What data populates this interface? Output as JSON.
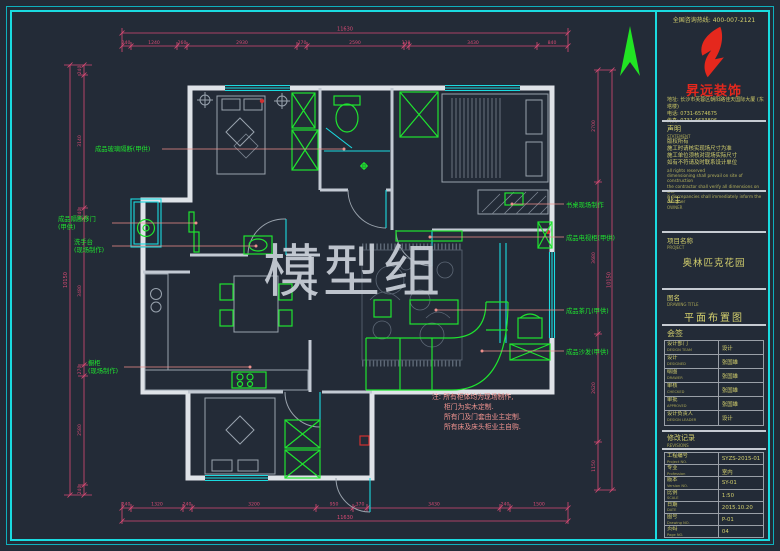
{
  "watermark": "模型组",
  "title_block": {
    "hotline": "全国咨询热线: 400-007-2121",
    "brand_name": "昇远装饰",
    "address": "地址: 长沙市芙蓉区朝阳路佳天国际大厦 (东塔楼)",
    "phone": "电话: 0731-6574675",
    "fax": "传真: 0731-4633806",
    "statement_label": "声明",
    "statement_sub": "STATEMENT",
    "statement_lines": [
      "版权所有",
      "施工时请核实现场尺寸为准",
      "施工单位须核对现场实际尺寸",
      "如有不符请及时联系设计单位"
    ],
    "statement_en": [
      "all rights reserved",
      "dimensioning shall prevail on site of construction",
      "the contractor shall verify all dimensions on site",
      "if discrepancies shall immediately inform the designer"
    ],
    "owner_label": "业主",
    "owner_sub": "OWNER",
    "project_label": "项目名称",
    "project_sub": "PROJECT",
    "project_name": "奥林匹克花园",
    "drawing_label": "图名",
    "drawing_sub": "DRAWING TITLE",
    "drawing_name": "平面布置图",
    "sign_label": "会签",
    "team_rows": [
      {
        "label": "设计部门",
        "sub": "DESIGN TEAM",
        "value": "设计"
      },
      {
        "label": "设计",
        "sub": "DESIGNED",
        "value": "张国雄"
      },
      {
        "label": "绘图",
        "sub": "DRAWER",
        "value": "张国雄"
      },
      {
        "label": "审核",
        "sub": "CHECKED",
        "value": "张国雄"
      },
      {
        "label": "审批",
        "sub": "APPROVED",
        "value": "张国雄"
      },
      {
        "label": "设计负责人",
        "sub": "DESIGN LEADER",
        "value": "设计"
      }
    ],
    "revision_label": "修改记录",
    "revision_sub": "REVISIONS",
    "info_rows": [
      {
        "label": "工程编号",
        "sub": "Project NO.",
        "value": "SYZS-2015-01"
      },
      {
        "label": "专业",
        "sub": "Profession",
        "value": "室内"
      },
      {
        "label": "版本",
        "sub": "Version NO.",
        "value": "SY-01"
      },
      {
        "label": "比例",
        "sub": "SCALE",
        "value": "1:50"
      },
      {
        "label": "日期",
        "sub": "DATE",
        "value": "2015.10.20"
      },
      {
        "label": "图号",
        "sub": "Drawing NO.",
        "value": "P-01"
      },
      {
        "label": "页码",
        "sub": "Page NO.",
        "value": "04"
      }
    ]
  },
  "plan": {
    "notes": [
      "注: 所有柜体均为现场制作,",
      "柜门为实木定制.",
      "所有门及门套由业主定制.",
      "所有床及床头柜业主自购."
    ],
    "callouts": {
      "glass_partition": "成品玻璃隔断(甲供)",
      "partition_door_1": "成品隔断移门",
      "partition_door_2": "(甲供)",
      "wash_basin_1": "洗手台",
      "wash_basin_2": "(现场制作)",
      "kitchen_cabinet_1": "橱柜",
      "kitchen_cabinet_2": "(现场制作)",
      "desk": "书桌现场制作",
      "tv_cabinet": "成品电视柜(甲供)",
      "tea_table": "成品茶几(甲供)",
      "sofa": "成品沙发(甲供)"
    },
    "dims": {
      "top_total": "11630",
      "top": [
        "240",
        "1240",
        "260",
        "2930",
        "270",
        "2590",
        "130",
        "3430",
        "840"
      ],
      "bottom": [
        "240",
        "1320",
        "240",
        "3200",
        "950",
        "370",
        "3430",
        "240",
        "1500"
      ],
      "bottom_total": "11630",
      "left": [
        "240",
        "3140",
        "240",
        "3480",
        "270",
        "2580",
        "240"
      ],
      "left_total": "10150",
      "right": [
        "2700",
        "3680",
        "2620",
        "1150"
      ],
      "right_total": "10150"
    }
  }
}
